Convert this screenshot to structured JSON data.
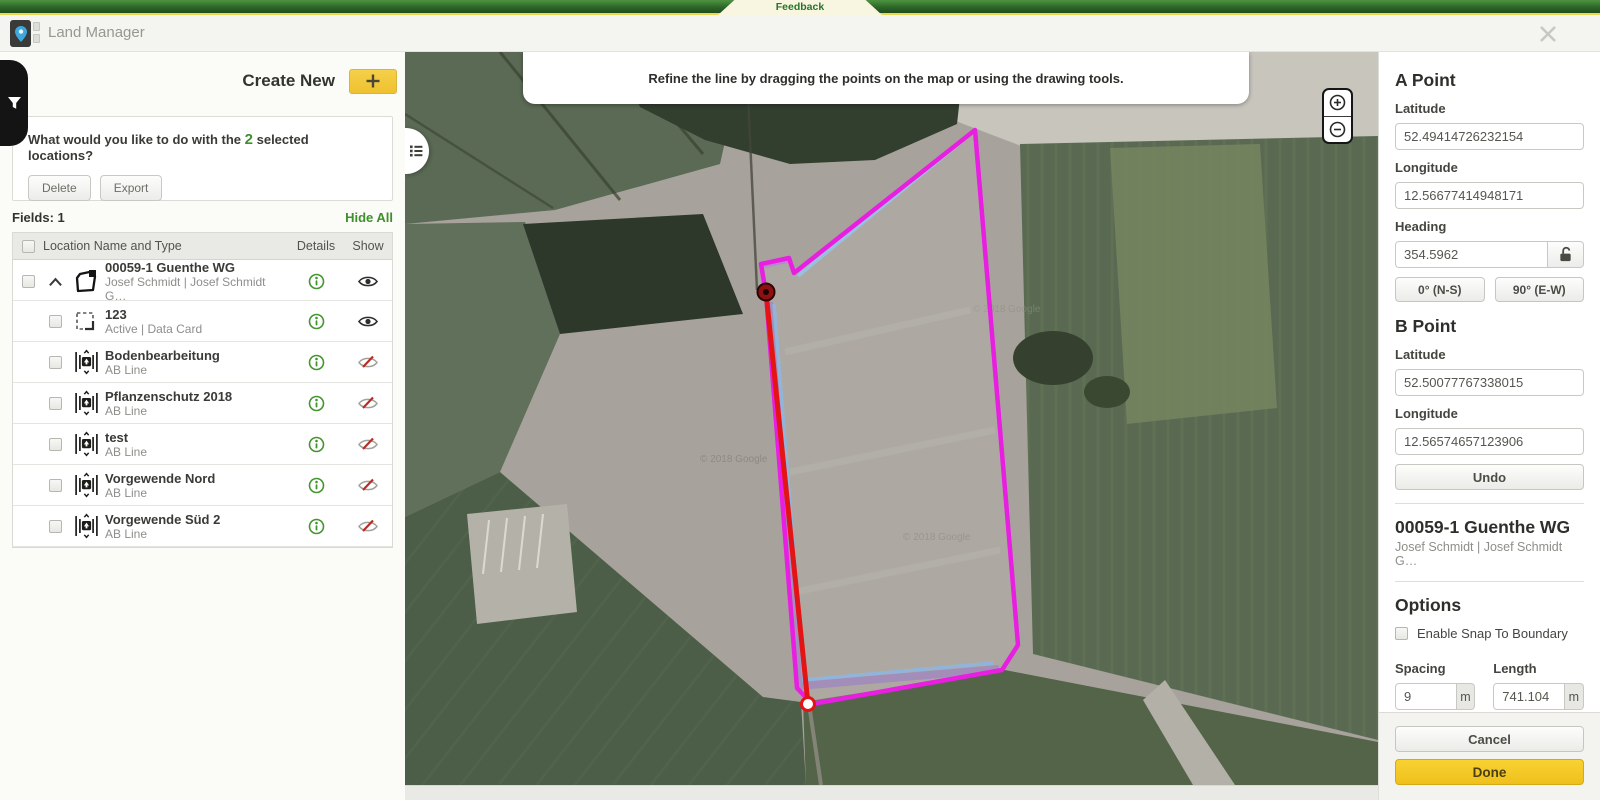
{
  "feedback_bar": {
    "label": "Feedback"
  },
  "header": {
    "title": "Land Manager"
  },
  "left_panel": {
    "create_new_label": "Create New",
    "selection_prompt": {
      "pre": "What would you like to do with the ",
      "count": "2",
      "post": " selected locations?"
    },
    "actions": {
      "delete": "Delete",
      "export": "Export"
    },
    "fields_label": "Fields: 1",
    "hide_all_label": "Hide All",
    "table": {
      "headers": {
        "name": "Location Name and Type",
        "details": "Details",
        "show": "Show"
      },
      "rows": [
        {
          "name": "00059-1 Guenthe WG",
          "subtitle": "Josef Schmidt | Josef Schmidt G…",
          "icon": "field-boundary-icon",
          "visible": true
        },
        {
          "name": "123",
          "subtitle": "Active | Data Card",
          "icon": "boundary-dashed-icon",
          "visible": true
        },
        {
          "name": "Bodenbearbeitung",
          "subtitle": "AB Line",
          "icon": "ab-line-icon",
          "visible": false
        },
        {
          "name": "Pflanzenschutz 2018",
          "subtitle": "AB Line",
          "icon": "ab-line-icon",
          "visible": false
        },
        {
          "name": "test",
          "subtitle": "AB Line",
          "icon": "ab-line-icon",
          "visible": false
        },
        {
          "name": "Vorgewende Nord",
          "subtitle": "AB Line",
          "icon": "ab-line-icon",
          "visible": false
        },
        {
          "name": "Vorgewende Süd 2",
          "subtitle": "AB Line",
          "icon": "ab-line-icon",
          "visible": false
        }
      ]
    }
  },
  "map": {
    "message": "Refine the line by dragging the points on the map or using the drawing tools.",
    "watermark": "© 2018 Google",
    "colors": {
      "boundary": "#e81ee0",
      "ab_line": "#8fc0ea",
      "refine_line": "#e41414",
      "headland": "#8d62d2"
    }
  },
  "right_panel": {
    "a_point": {
      "title": "A Point",
      "latitude_label": "Latitude",
      "latitude": "52.49414726232154",
      "longitude_label": "Longitude",
      "longitude": "12.56677414948171",
      "heading_label": "Heading",
      "heading": "354.5962",
      "ns_button": "0° (N-S)",
      "ew_button": "90° (E-W)"
    },
    "b_point": {
      "title": "B Point",
      "latitude_label": "Latitude",
      "latitude": "52.50077767338015",
      "longitude_label": "Longitude",
      "longitude": "12.56574657123906"
    },
    "undo_label": "Undo",
    "field_name": "00059-1 Guenthe WG",
    "field_owner": "Josef Schmidt | Josef Schmidt G…",
    "options": {
      "title": "Options",
      "snap_label": "Enable Snap To Boundary",
      "spacing_label": "Spacing",
      "spacing_value": "9",
      "spacing_unit": "m",
      "length_label": "Length",
      "length_value": "741.104",
      "length_unit": "m"
    },
    "cancel_label": "Cancel",
    "done_label": "Done"
  }
}
